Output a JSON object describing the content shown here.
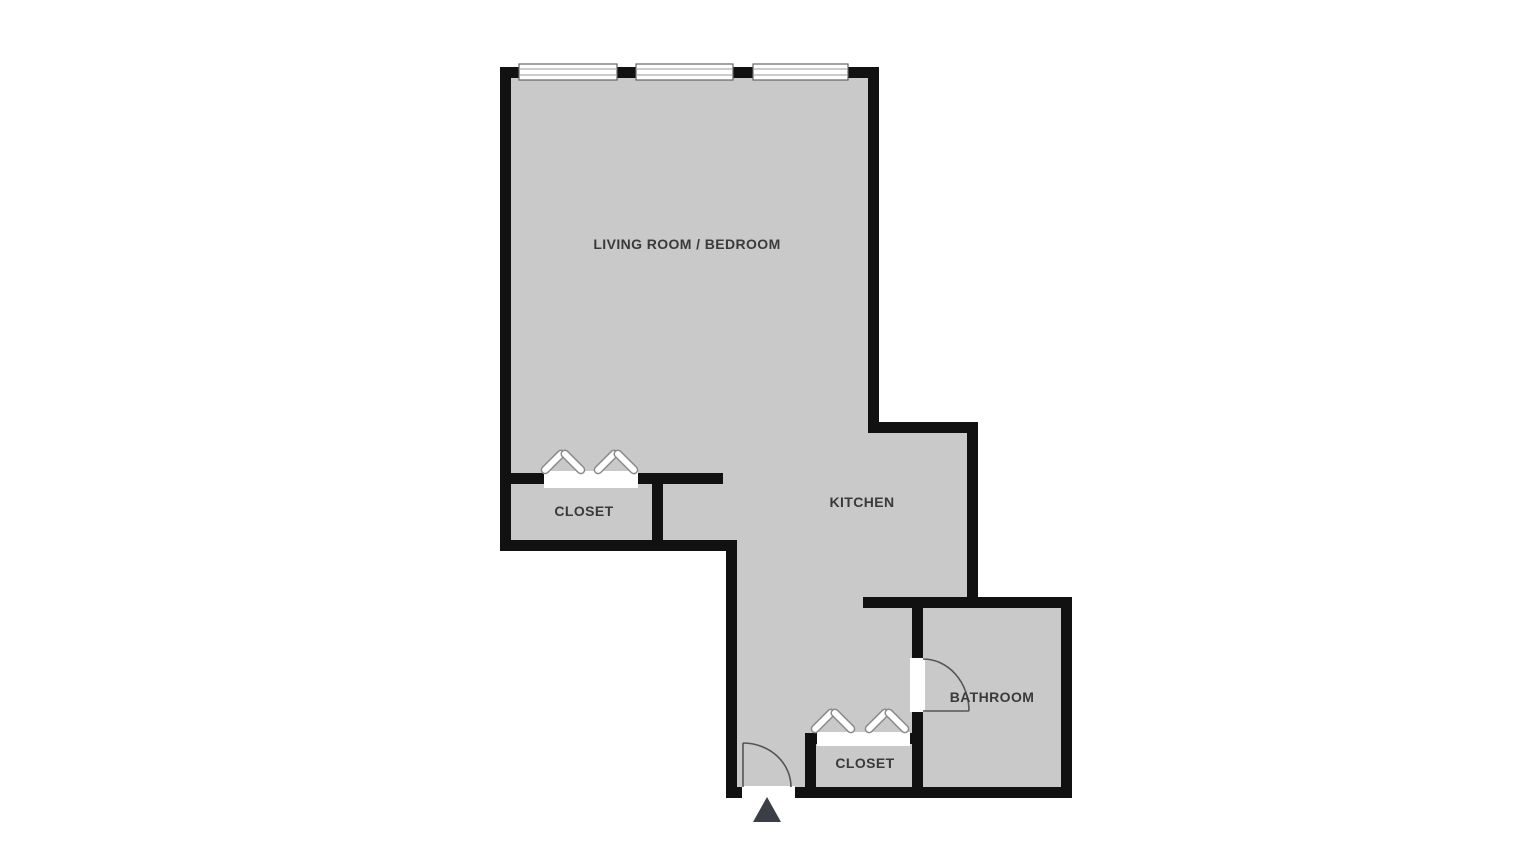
{
  "title": "Studio apartment floor plan",
  "colors": {
    "floor": "#c9c9c9",
    "wall": "#111111",
    "label": "#3a3a3a",
    "door_arc": "#555555",
    "symbol_outline": "#8a8a8a",
    "entry_arrow": "#3a3f47",
    "background": "#ffffff"
  },
  "rooms": {
    "living_room": {
      "label": "LIVING ROOM / BEDROOM"
    },
    "closet_upper": {
      "label": "CLOSET"
    },
    "kitchen": {
      "label": "KITCHEN"
    },
    "closet_lower": {
      "label": "CLOSET"
    },
    "bathroom": {
      "label": "BATHROOM"
    }
  },
  "symbols": {
    "windows": 3,
    "door_swings": 2,
    "closet_rod_hangers": 4,
    "entrance_arrow": 1
  }
}
